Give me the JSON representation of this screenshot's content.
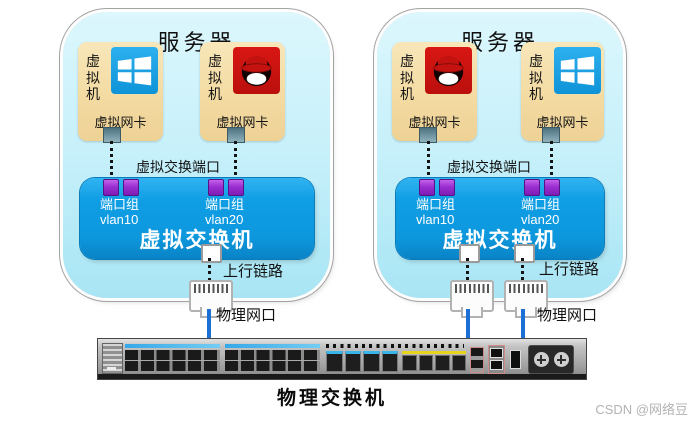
{
  "servers": [
    {
      "title": "服务器",
      "vms": [
        {
          "label": "虚拟机",
          "os": "windows",
          "nic_label": "虚拟网卡"
        },
        {
          "label": "虚拟机",
          "os": "redhat",
          "nic_label": "虚拟网卡"
        }
      ],
      "vswitch_port_label": "虚拟交换端口",
      "port_groups": [
        {
          "name": "端口组",
          "vlan": "vlan10"
        },
        {
          "name": "端口组",
          "vlan": "vlan20"
        }
      ],
      "vswitch_label": "虚拟交换机",
      "uplink_label": "上行链路",
      "physical_port_label": "物理网口",
      "uplink_count": 1
    },
    {
      "title": "服务器",
      "vms": [
        {
          "label": "虚拟机",
          "os": "redhat",
          "nic_label": "虚拟网卡"
        },
        {
          "label": "虚拟机",
          "os": "windows",
          "nic_label": "虚拟网卡"
        }
      ],
      "vswitch_port_label": "虚拟交换端口",
      "port_groups": [
        {
          "name": "端口组",
          "vlan": "vlan10"
        },
        {
          "name": "端口组",
          "vlan": "vlan20"
        }
      ],
      "vswitch_label": "虚拟交换机",
      "uplink_label": "上行链路",
      "physical_port_label": "物理网口",
      "uplink_count": 2
    }
  ],
  "physical_switch": {
    "label": "物理交换机"
  },
  "watermark": "CSDN @网络豆",
  "colors": {
    "server_fill": "#c6f0fa",
    "vm_fill": "#f3dba2",
    "vswitch_blue": "#0d98de",
    "port_purple": "#9a2fd0",
    "link_blue": "#1c6fd4",
    "windows_blue": "#1ba1e2",
    "redhat_red": "#cc1310"
  }
}
